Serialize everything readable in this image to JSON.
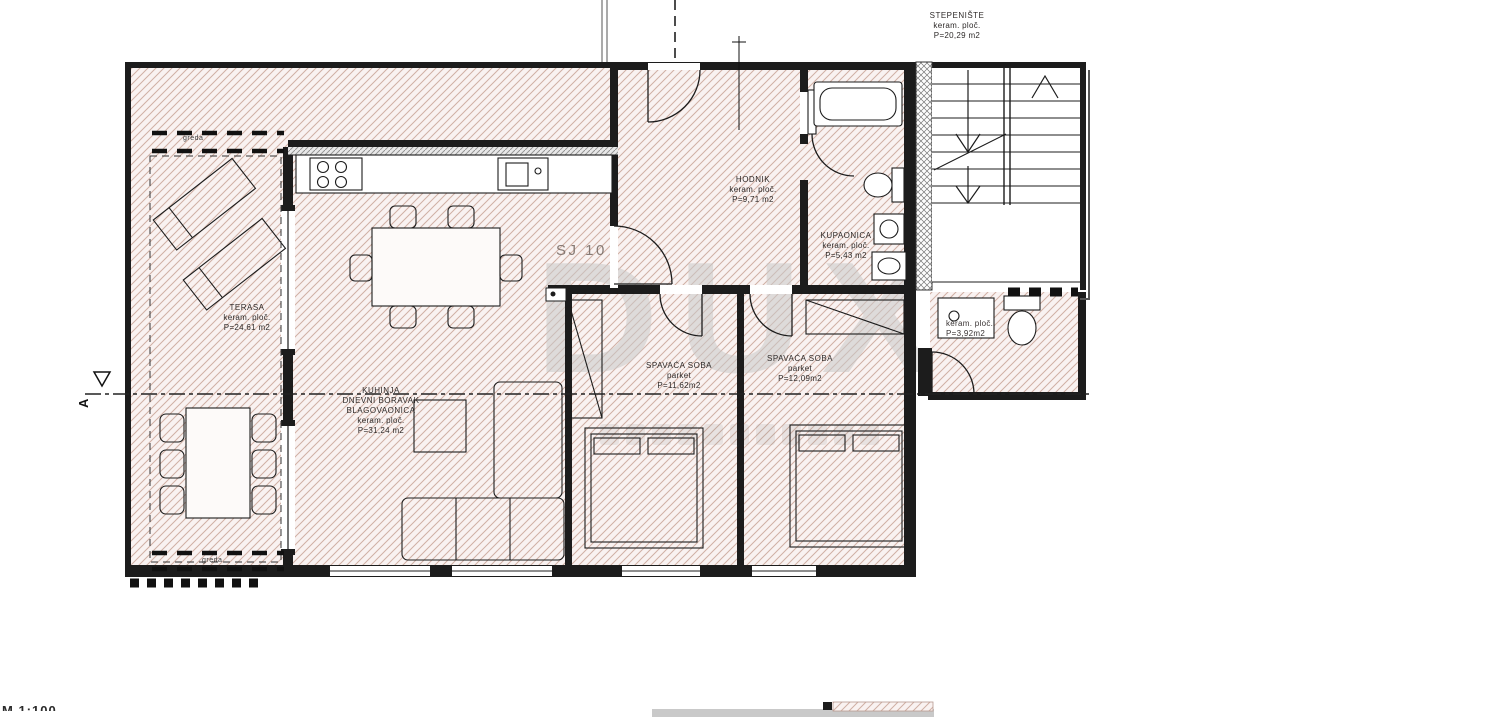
{
  "drawing": {
    "unit_label": "SJ 10",
    "scale_fragment": "M 1:100",
    "watermark_text": "DUX",
    "section_marker": "A",
    "beam_label_top": "greda",
    "beam_label_bottom": "greda"
  },
  "rooms": [
    {
      "id": "stepeniste",
      "name": "STEPENIŠTE",
      "finish": "keram. ploč.",
      "area": "P=20,29 m2"
    },
    {
      "id": "hodnik",
      "name": "HODNIK",
      "finish": "keram. ploč.",
      "area": "P=9,71 m2"
    },
    {
      "id": "kupaonica",
      "name": "KUPAONICA",
      "finish": "keram. ploč.",
      "area": "P=5,43 m2"
    },
    {
      "id": "terasa",
      "name": "TERASA",
      "finish": "keram. ploč.",
      "area": "P=24,61 m2"
    },
    {
      "id": "dnevni",
      "name": "KUHINJA",
      "name2": "DNEVNI BORAVAK",
      "name3": "BLAGOVAONICA",
      "finish": "keram. ploč.",
      "area": "P=31,24 m2"
    },
    {
      "id": "spavaca1",
      "name": "SPAVAĆA SOBA",
      "finish": "parket",
      "area": "P=11,62m2"
    },
    {
      "id": "spavaca2",
      "name": "SPAVAĆA SOBA",
      "finish": "parket",
      "area": "P=12,09m2"
    },
    {
      "id": "wc",
      "name": "",
      "finish": "keram. ploč.",
      "area": "P=3,92m2"
    }
  ],
  "colors": {
    "wall": "#1c1c1c",
    "hatch_bg": "#f9f2f1",
    "hatch_line": "#d0b0a4",
    "gray_wall": "#8f8f8f",
    "watermark": "#c9c9c9"
  }
}
